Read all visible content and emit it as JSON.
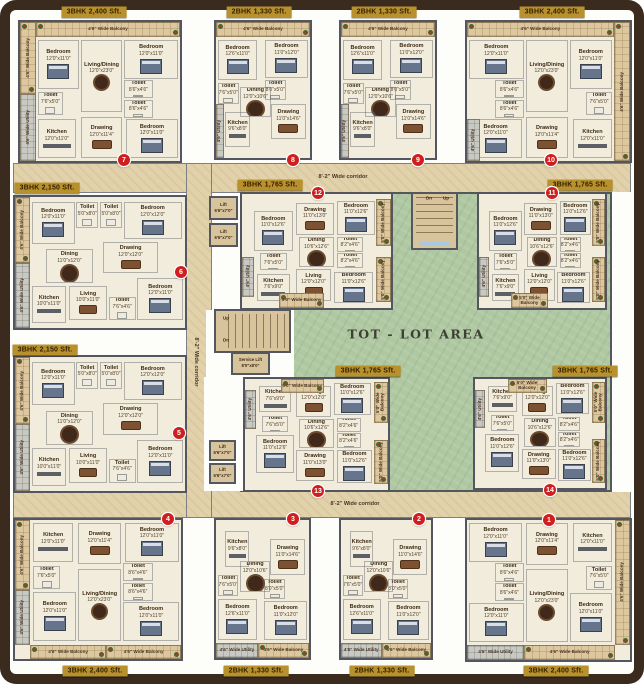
{
  "canvas": {
    "w": 644,
    "h": 684
  },
  "palette": {
    "frame": "#3a2b1e",
    "corridor": "#e2d2ab",
    "courtyard_green": "#afc8a2",
    "unit_floor": "#f1ecdc",
    "wall": "#53565e",
    "balcony": "#dcc79e",
    "utility": "#c9c9c3",
    "stair": "#d8c49c",
    "badge_bg": "#b8912c",
    "badge_text": "#321f04",
    "number_red": "#cf1e1e"
  },
  "courtyard": {
    "label": "TOT - LOT AREA",
    "x": 240,
    "y": 192,
    "w": 372,
    "h": 300,
    "label_x": 416,
    "label_y": 334
  },
  "corridors": [
    {
      "name": "corridor-top",
      "x": 13,
      "y": 163,
      "w": 618,
      "h": 30
    },
    {
      "name": "corridor-bottom",
      "x": 13,
      "y": 490,
      "w": 618,
      "h": 28
    },
    {
      "name": "corridor-left",
      "x": 186,
      "y": 163,
      "w": 26,
      "h": 355
    }
  ],
  "corridor_labels": [
    {
      "text": "8'-2\" Wide corridor",
      "x": 343,
      "y": 177,
      "vertical": false
    },
    {
      "text": "8'-2\" Wide corridor",
      "x": 355,
      "y": 504,
      "vertical": false
    },
    {
      "text": "8'-2\" Wide corridor",
      "x": 196,
      "y": 362,
      "vertical": true
    }
  ],
  "patches": [
    {
      "x": 206,
      "y": 310,
      "w": 88,
      "h": 68
    },
    {
      "x": 204,
      "y": 377,
      "w": 39,
      "h": 114
    },
    {
      "x": 612,
      "y": 192,
      "w": 20,
      "h": 300
    }
  ],
  "stairs": [
    {
      "name": "central-stairs",
      "x": 411,
      "y": 192,
      "w": 47,
      "h": 58,
      "dir": "h",
      "landing": "bottom"
    },
    {
      "name": "west-stairs",
      "x": 214,
      "y": 309,
      "w": 77,
      "h": 44,
      "dir": "v",
      "landing": "left"
    }
  ],
  "stair_labels": [
    {
      "t": "Dn",
      "x": 429,
      "y": 198
    },
    {
      "t": "Up",
      "x": 446,
      "y": 198
    },
    {
      "t": "Up",
      "x": 226,
      "y": 318
    },
    {
      "t": "Dn",
      "x": 226,
      "y": 340
    }
  ],
  "lifts": [
    {
      "label": "Lift",
      "dims": "6'6\"x7'0\"",
      "x": 209,
      "y": 196,
      "w": 29,
      "h": 24
    },
    {
      "label": "Lift",
      "dims": "6'6\"x7'0\"",
      "x": 209,
      "y": 223,
      "w": 29,
      "h": 24
    },
    {
      "label": "Lift",
      "dims": "6'6\"x7'0\"",
      "x": 209,
      "y": 440,
      "w": 27,
      "h": 21
    },
    {
      "label": "Lift",
      "dims": "6'6\"x7'0\"",
      "x": 209,
      "y": 463,
      "w": 27,
      "h": 21
    },
    {
      "label": "Service Lift",
      "dims": "8'0\"x8'0\"",
      "x": 231,
      "y": 352,
      "w": 39,
      "h": 23
    }
  ],
  "unit_types": {
    "A": {
      "label": "3BHK 2,400 Sft.",
      "rooms": [
        {
          "n": "Bedroom",
          "d": "12'0\"x11'0\"",
          "x": 11,
          "y": 13,
          "w": 26,
          "h": 35
        },
        {
          "n": "Living/Dining",
          "d": "12'0\"x23'0\"",
          "x": 38,
          "y": 13,
          "w": 26,
          "h": 52
        },
        {
          "n": "Bedroom",
          "d": "12'0\"x11'0\"",
          "x": 65,
          "y": 13,
          "w": 34,
          "h": 28
        },
        {
          "n": "Toilet",
          "d": "7'6\"x5'0\"",
          "x": 11,
          "y": 50,
          "w": 16,
          "h": 17
        },
        {
          "n": "Toilet",
          "d": "8'6\"x4'6\"",
          "x": 65,
          "y": 42,
          "w": 18,
          "h": 13
        },
        {
          "n": "Toilet",
          "d": "8'6\"x4'6\"",
          "x": 65,
          "y": 56,
          "w": 18,
          "h": 13
        },
        {
          "n": "Kitchen",
          "d": "12'0\"x11'0\"",
          "x": 11,
          "y": 70,
          "w": 24,
          "h": 28
        },
        {
          "n": "Drawing",
          "d": "12'0\"x11'4\"",
          "x": 38,
          "y": 68,
          "w": 26,
          "h": 30
        },
        {
          "n": "Bedroom",
          "d": "12'0\"x11'0\"",
          "x": 66,
          "y": 70,
          "w": 33,
          "h": 28
        }
      ]
    },
    "B": {
      "label": "2BHK 1,330 Sft.",
      "rooms": [
        {
          "n": "Bedroom",
          "d": "12'6\"x11'0\"",
          "x": 2,
          "y": 13,
          "w": 42,
          "h": 30
        },
        {
          "n": "Bedroom",
          "d": "11'0\"x12'0\"",
          "x": 52,
          "y": 13,
          "w": 46,
          "h": 28
        },
        {
          "n": "Toilet",
          "d": "7'6\"x5'0\"",
          "x": 2,
          "y": 45,
          "w": 22,
          "h": 15
        },
        {
          "n": "Toilet",
          "d": "8'0\"x5'0\"",
          "x": 52,
          "y": 43,
          "w": 22,
          "h": 14
        },
        {
          "n": "Dining",
          "d": "12'0\"x10'6\"",
          "x": 26,
          "y": 48,
          "w": 32,
          "h": 22
        },
        {
          "n": "Drawing",
          "d": "11'0\"x14'6\"",
          "x": 58,
          "y": 60,
          "w": 38,
          "h": 26
        },
        {
          "n": "Kitchen",
          "d": "9'6\"x8'0\"",
          "x": 10,
          "y": 66,
          "w": 26,
          "h": 26
        }
      ]
    },
    "C": {
      "label": "3BHK 2,150 Sft.",
      "rooms": [
        {
          "n": "Bedroom",
          "d": "12'0\"x11'0\"",
          "x": 10,
          "y": 4,
          "w": 25,
          "h": 32
        },
        {
          "n": "Toilet",
          "d": "5'0\"x8'0\"",
          "x": 36,
          "y": 4,
          "w": 13,
          "h": 20
        },
        {
          "n": "Toilet",
          "d": "5'0\"x8'0\"",
          "x": 50,
          "y": 4,
          "w": 13,
          "h": 20
        },
        {
          "n": "Bedroom",
          "d": "12'0\"x12'0\"",
          "x": 64,
          "y": 4,
          "w": 34,
          "h": 28
        },
        {
          "n": "Dining",
          "d": "11'0\"x12'0\"",
          "x": 18,
          "y": 40,
          "w": 28,
          "h": 26
        },
        {
          "n": "Drawing",
          "d": "12'0\"x12'0\"",
          "x": 52,
          "y": 34,
          "w": 32,
          "h": 24
        },
        {
          "n": "Living",
          "d": "10'0\"x11'0\"",
          "x": 32,
          "y": 68,
          "w": 22,
          "h": 26
        },
        {
          "n": "Kitchen",
          "d": "10'0\"x11'0\"",
          "x": 10,
          "y": 68,
          "w": 20,
          "h": 28
        },
        {
          "n": "Toilet",
          "d": "7'6\"x4'6\"",
          "x": 55,
          "y": 76,
          "w": 16,
          "h": 18
        },
        {
          "n": "Bedroom",
          "d": "12'0\"x11'0\"",
          "x": 72,
          "y": 62,
          "w": 27,
          "h": 32
        }
      ]
    },
    "D": {
      "label": "3BHK 1,765 Sft.",
      "rooms": [
        {
          "n": "Bedroom",
          "d": "11'0\"x12'6\"",
          "x": 8,
          "y": 15,
          "w": 26,
          "h": 35
        },
        {
          "n": "Drawing",
          "d": "11'0\"x13'0\"",
          "x": 36,
          "y": 8,
          "w": 26,
          "h": 28
        },
        {
          "n": "Bedroom",
          "d": "11'0\"x12'6\"",
          "x": 64,
          "y": 6,
          "w": 25,
          "h": 30
        },
        {
          "n": "Dining",
          "d": "10'6\"x12'6\"",
          "x": 38,
          "y": 38,
          "w": 24,
          "h": 26
        },
        {
          "n": "Toilet",
          "d": "7'6\"x5'0\"",
          "x": 12,
          "y": 52,
          "w": 18,
          "h": 15
        },
        {
          "n": "Toilet",
          "d": "8'2\"x4'6\"",
          "x": 64,
          "y": 38,
          "w": 17,
          "h": 13
        },
        {
          "n": "Toilet",
          "d": "8'2\"x4'6\"",
          "x": 64,
          "y": 52,
          "w": 17,
          "h": 13
        },
        {
          "n": "Kitchen",
          "d": "7'6\"x9'0\"",
          "x": 10,
          "y": 70,
          "w": 22,
          "h": 24
        },
        {
          "n": "Living",
          "d": "12'0\"x12'0\"",
          "x": 36,
          "y": 66,
          "w": 24,
          "h": 28
        },
        {
          "n": "Bedroom",
          "d": "11'0\"x12'6\"",
          "x": 62,
          "y": 68,
          "w": 26,
          "h": 28
        }
      ]
    }
  },
  "units": [
    {
      "num": "7",
      "type": "A",
      "badge": "3BHK 2,400 Sft.",
      "x": 18,
      "y": 20,
      "w": 164,
      "h": 143,
      "mx": false,
      "my": false,
      "bx": 94,
      "by": 12,
      "nx": 124,
      "ny": 160,
      "strips": [
        {
          "k": "b",
          "l": "4'6\" Wide Balcony",
          "x": 10,
          "y": 0,
          "w": 90,
          "h": 11,
          "v": false
        },
        {
          "k": "b",
          "l": "4'6\" Wide Balcony",
          "x": 0,
          "y": 0,
          "w": 10,
          "h": 52,
          "v": true
        },
        {
          "k": "u",
          "l": "4'6\" Wide Utility",
          "x": 0,
          "y": 52,
          "w": 10,
          "h": 48,
          "v": true
        }
      ]
    },
    {
      "num": "8",
      "type": "B",
      "badge": "2BHK 1,330 Sft.",
      "x": 214,
      "y": 20,
      "w": 98,
      "h": 140,
      "mx": false,
      "my": false,
      "bx": 259,
      "by": 12,
      "nx": 293,
      "ny": 160,
      "strips": [
        {
          "k": "b",
          "l": "4'6\" Wide Balcony",
          "x": 0,
          "y": 0,
          "w": 100,
          "h": 11,
          "v": false
        },
        {
          "k": "u",
          "l": "4'6\" Utility",
          "x": 0,
          "y": 60,
          "w": 8,
          "h": 40,
          "v": true
        }
      ]
    },
    {
      "num": "9",
      "type": "B",
      "badge": "2BHK 1,330 Sft.",
      "x": 339,
      "y": 20,
      "w": 98,
      "h": 140,
      "mx": false,
      "my": false,
      "bx": 384,
      "by": 12,
      "nx": 418,
      "ny": 160,
      "strips": [
        {
          "k": "b",
          "l": "4'6\" Wide Balcony",
          "x": 0,
          "y": 0,
          "w": 100,
          "h": 11,
          "v": false
        },
        {
          "k": "u",
          "l": "4'6\" Utility",
          "x": 0,
          "y": 60,
          "w": 8,
          "h": 40,
          "v": true
        }
      ]
    },
    {
      "num": "10",
      "type": "A",
      "badge": "3BHK 2,400 Sft.",
      "x": 465,
      "y": 20,
      "w": 167,
      "h": 143,
      "mx": true,
      "my": false,
      "bx": 552,
      "by": 12,
      "nx": 551,
      "ny": 160,
      "strips": [
        {
          "k": "b",
          "l": "4'6\" Wide Balcony",
          "x": 0,
          "y": 0,
          "w": 90,
          "h": 11,
          "v": false
        },
        {
          "k": "b",
          "l": "4'6\" Wide Balcony",
          "x": 90,
          "y": 0,
          "w": 10,
          "h": 100,
          "v": true
        },
        {
          "k": "u",
          "l": "4'6\" Utility",
          "x": 0,
          "y": 70,
          "w": 8,
          "h": 30,
          "v": true
        }
      ]
    },
    {
      "num": "6",
      "type": "C",
      "badge": "3BHK 2,150 Sft.",
      "x": 13,
      "y": 195,
      "w": 174,
      "h": 135,
      "mx": false,
      "my": false,
      "bx": 47,
      "by": 188,
      "nx": 181,
      "ny": 272,
      "strips": [
        {
          "k": "b",
          "l": "4'6\" Wide Balcony",
          "x": 0,
          "y": 0,
          "w": 9,
          "h": 50,
          "v": true
        },
        {
          "k": "u",
          "l": "4'6\" Wide Utility",
          "x": 0,
          "y": 50,
          "w": 9,
          "h": 50,
          "v": true
        }
      ]
    },
    {
      "num": "5",
      "type": "C",
      "badge": "3BHK 2,150 Sft.",
      "x": 13,
      "y": 355,
      "w": 174,
      "h": 138,
      "mx": false,
      "my": false,
      "bx": 45,
      "by": 350,
      "nx": 179,
      "ny": 433,
      "strips": [
        {
          "k": "b",
          "l": "4'6\" Wide Balcony",
          "x": 0,
          "y": 0,
          "w": 9,
          "h": 50,
          "v": true
        },
        {
          "k": "u",
          "l": "4'6\" Wide Utility",
          "x": 0,
          "y": 50,
          "w": 9,
          "h": 50,
          "v": true
        }
      ]
    },
    {
      "num": "12",
      "type": "D",
      "badge": "3BHK 1,765 Sft.",
      "x": 240,
      "y": 192,
      "w": 153,
      "h": 118,
      "mx": false,
      "my": false,
      "bx": 270,
      "by": 185,
      "nx": 318,
      "ny": 193,
      "strips": [
        {
          "k": "b",
          "l": "5'0\" Wide Balcony",
          "x": 25,
          "y": 87,
          "w": 30,
          "h": 13,
          "v": false
        },
        {
          "k": "b",
          "l": "5'0\" Wide Balcony",
          "x": 90,
          "y": 4,
          "w": 10,
          "h": 42,
          "v": true
        },
        {
          "k": "b",
          "l": "5'0\" Wide Balcony",
          "x": 90,
          "y": 55,
          "w": 10,
          "h": 40,
          "v": true
        },
        {
          "k": "u",
          "l": "4'6\" Utility",
          "x": 0,
          "y": 55,
          "w": 8,
          "h": 35,
          "v": true
        }
      ]
    },
    {
      "num": "11",
      "type": "D",
      "badge": "3BHK 1,765 Sft.",
      "x": 477,
      "y": 192,
      "w": 130,
      "h": 118,
      "mx": false,
      "my": false,
      "bx": 580,
      "by": 185,
      "nx": 552,
      "ny": 193,
      "strips": [
        {
          "k": "b",
          "l": "5'0\" Wide Balcony",
          "x": 25,
          "y": 87,
          "w": 30,
          "h": 13,
          "v": false
        },
        {
          "k": "b",
          "l": "5'0\" Wide Balcony",
          "x": 90,
          "y": 4,
          "w": 10,
          "h": 42,
          "v": true
        },
        {
          "k": "b",
          "l": "5'0\" Wide Balcony",
          "x": 90,
          "y": 55,
          "w": 10,
          "h": 40,
          "v": true
        },
        {
          "k": "u",
          "l": "4'6\" Utility",
          "x": 0,
          "y": 55,
          "w": 8,
          "h": 35,
          "v": true
        }
      ]
    },
    {
      "num": "13",
      "type": "D",
      "badge": "3BHK 1,765 Sft.",
      "x": 243,
      "y": 377,
      "w": 147,
      "h": 115,
      "mx": false,
      "my": true,
      "bx": 368,
      "by": 371,
      "nx": 318,
      "ny": 491,
      "strips": [
        {
          "k": "b",
          "l": "5'0\" Wide Balcony",
          "x": 25,
          "y": 0,
          "w": 30,
          "h": 13,
          "v": false
        },
        {
          "k": "b",
          "l": "5'0\" Wide Balcony",
          "x": 90,
          "y": 3,
          "w": 10,
          "h": 37,
          "v": true
        },
        {
          "k": "b",
          "l": "5'0\" Wide Balcony",
          "x": 90,
          "y": 55,
          "w": 10,
          "h": 40,
          "v": true
        },
        {
          "k": "u",
          "l": "4'6\" Utility",
          "x": 0,
          "y": 10,
          "w": 8,
          "h": 35,
          "v": true
        }
      ]
    },
    {
      "num": "14",
      "type": "D",
      "badge": "3BHK 1,765 Sft.",
      "x": 473,
      "y": 377,
      "w": 134,
      "h": 113,
      "mx": false,
      "my": true,
      "bx": 585,
      "by": 371,
      "nx": 550,
      "ny": 490,
      "strips": [
        {
          "k": "b",
          "l": "5'0\" Wide Balcony",
          "x": 25,
          "y": 0,
          "w": 30,
          "h": 13,
          "v": false
        },
        {
          "k": "b",
          "l": "5'0\" Wide Balcony",
          "x": 90,
          "y": 3,
          "w": 10,
          "h": 37,
          "v": true
        },
        {
          "k": "b",
          "l": "5'0\" Wide Balcony",
          "x": 90,
          "y": 55,
          "w": 10,
          "h": 40,
          "v": true
        },
        {
          "k": "u",
          "l": "4'6\" Utility",
          "x": 0,
          "y": 10,
          "w": 8,
          "h": 35,
          "v": true
        }
      ]
    },
    {
      "num": "4",
      "type": "A",
      "badge": "3BHK 2,400 Sft.",
      "x": 13,
      "y": 518,
      "w": 170,
      "h": 143,
      "mx": false,
      "my": true,
      "bx": 95,
      "by": 671,
      "nx": 168,
      "ny": 519,
      "strips": [
        {
          "k": "b",
          "l": "4'6\" Wide Balcony",
          "x": 9,
          "y": 90,
          "w": 46,
          "h": 10,
          "v": false
        },
        {
          "k": "b",
          "l": "4'6\" Wide Balcony",
          "x": 55,
          "y": 90,
          "w": 45,
          "h": 10,
          "v": false
        },
        {
          "k": "b",
          "l": "4'6\" Wide Balcony",
          "x": 0,
          "y": 0,
          "w": 9,
          "h": 50,
          "v": true
        },
        {
          "k": "u",
          "l": "4'6\" Wide Utility",
          "x": 0,
          "y": 50,
          "w": 9,
          "h": 40,
          "v": true
        }
      ]
    },
    {
      "num": "3",
      "type": "B",
      "badge": "2BHK 1,330 Sft.",
      "x": 214,
      "y": 518,
      "w": 97,
      "h": 142,
      "mx": false,
      "my": true,
      "bx": 256,
      "by": 671,
      "nx": 293,
      "ny": 519,
      "strips": [
        {
          "k": "u",
          "l": "4'6\" Wide Utility",
          "x": 0,
          "y": 89,
          "w": 45,
          "h": 11,
          "v": false
        },
        {
          "k": "b",
          "l": "4'6\" Wide Balcony",
          "x": 45,
          "y": 89,
          "w": 55,
          "h": 11,
          "v": false
        }
      ]
    },
    {
      "num": "2",
      "type": "B",
      "badge": "2BHK 1,330 Sft.",
      "x": 339,
      "y": 518,
      "w": 94,
      "h": 142,
      "mx": false,
      "my": true,
      "bx": 382,
      "by": 671,
      "nx": 419,
      "ny": 519,
      "strips": [
        {
          "k": "u",
          "l": "4'6\" Wide Utility",
          "x": 0,
          "y": 89,
          "w": 45,
          "h": 11,
          "v": false
        },
        {
          "k": "b",
          "l": "4'6\" Wide Balcony",
          "x": 45,
          "y": 89,
          "w": 55,
          "h": 11,
          "v": false
        }
      ]
    },
    {
      "num": "1",
      "type": "A",
      "badge": "3BHK 2,400 Sft.",
      "x": 465,
      "y": 518,
      "w": 167,
      "h": 144,
      "mx": true,
      "my": true,
      "bx": 556,
      "by": 671,
      "nx": 549,
      "ny": 520,
      "strips": [
        {
          "k": "u",
          "l": "4'6\" Wide Utility",
          "x": 0,
          "y": 89,
          "w": 35,
          "h": 11,
          "v": false
        },
        {
          "k": "b",
          "l": "4'6\" Wide Balcony",
          "x": 35,
          "y": 89,
          "w": 56,
          "h": 11,
          "v": false
        },
        {
          "k": "b",
          "l": "4'6\" Wide Balcony",
          "x": 91,
          "y": 0,
          "w": 9,
          "h": 89,
          "v": true
        }
      ]
    }
  ]
}
